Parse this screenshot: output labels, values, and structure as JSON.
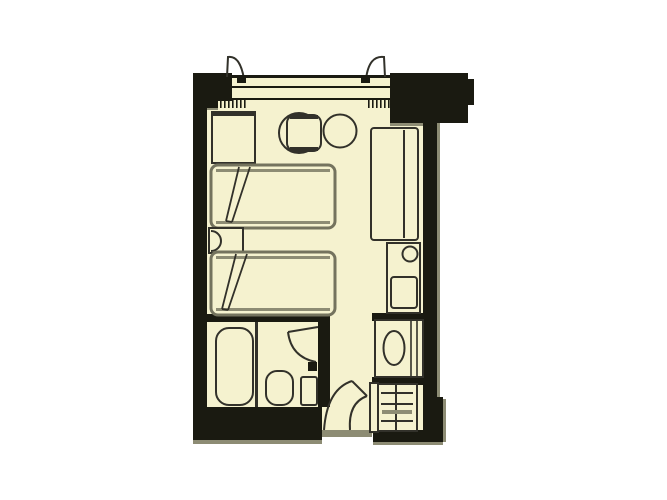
{
  "page": {
    "kind": "hotel-room-floor-plan"
  },
  "colors": {
    "background": "#ffffff",
    "floor": "#f5f2cf",
    "wall": "#1a1a11",
    "line": "#32312a",
    "bedline": "#74735e",
    "shadow": "#8d8c74"
  },
  "plan": {
    "rooms": [
      "bedroom",
      "bathroom",
      "entry-corridor"
    ],
    "furniture": [
      "window",
      "curtain-left",
      "curtain-right",
      "curtain-box-left",
      "curtain-box-right",
      "cabinet",
      "cafe-table",
      "chair-round-large",
      "chair-round-small",
      "twin-bed-1",
      "twin-bed-2",
      "nightstand",
      "nightstand-lamp",
      "counter-desk",
      "kettle",
      "minibar-fridge",
      "washbasin",
      "closet-shelves",
      "entry-door",
      "bathroom-door",
      "bathtub",
      "toilet",
      "hand-basin"
    ]
  }
}
